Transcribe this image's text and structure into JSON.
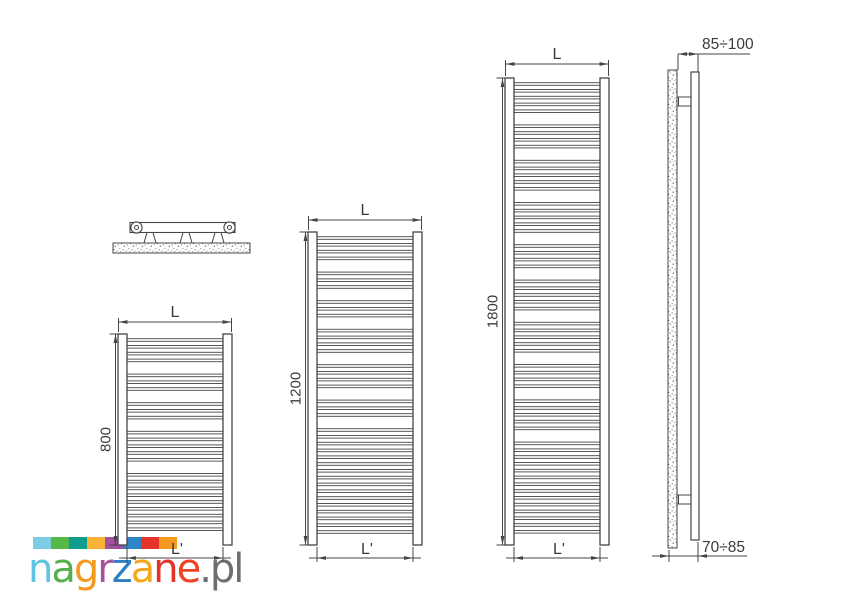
{
  "logo": {
    "letters": [
      {
        "ch": "n",
        "color": "#5fc4e1"
      },
      {
        "ch": "a",
        "color": "#55b04b"
      },
      {
        "ch": "g",
        "color": "#f5991f"
      },
      {
        "ch": "r",
        "color": "#a8519f"
      },
      {
        "ch": "z",
        "color": "#2e7fc1"
      },
      {
        "ch": "a",
        "color": "#f4a71c"
      },
      {
        "ch": "n",
        "color": "#e6332a"
      },
      {
        "ch": "e",
        "color": "#ef4123"
      }
    ],
    "suffix": {
      "text": ".pl",
      "color": "#6d6e71"
    },
    "squares": [
      "#7dcae4",
      "#56b847",
      "#0e9c8d",
      "#f9b233",
      "#a4509e",
      "#2e86c6",
      "#e6332a",
      "#f5991f"
    ]
  },
  "diagram": {
    "line_color": "#454545",
    "text_color": "#3a3a3a",
    "radiators": [
      {
        "id": "radiator-800",
        "width_label": "L",
        "height_label": "800",
        "bottom_width_label": "L'",
        "rung_groups": [
          4,
          3,
          3,
          5,
          9
        ]
      },
      {
        "id": "radiator-1200",
        "width_label": "L",
        "height_label": "1200",
        "bottom_width_label": "L'",
        "rung_groups": [
          4,
          3,
          3,
          4,
          4,
          3,
          16
        ]
      },
      {
        "id": "radiator-1800",
        "width_label": "L",
        "height_label": "1800",
        "bottom_width_label": "L'",
        "rung_groups": [
          5,
          4,
          5,
          5,
          4,
          5,
          5,
          4,
          5,
          14
        ]
      }
    ],
    "side_view": {
      "top_dim_label": "85÷100",
      "bottom_dim_label": "70÷85"
    }
  }
}
